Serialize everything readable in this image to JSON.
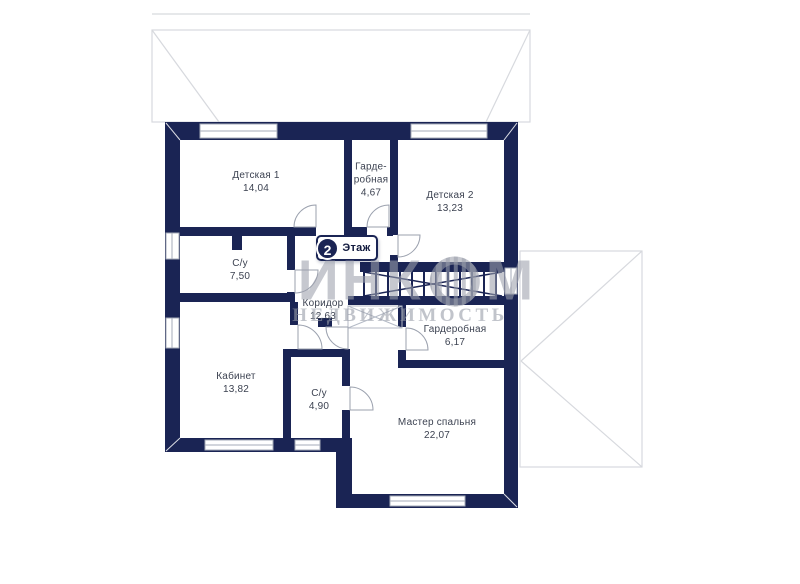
{
  "floor_badge": {
    "number": "2",
    "label": "Этаж"
  },
  "watermark": {
    "brand_pre": "ИНК",
    "brand_post": "М",
    "subtitle": "НЕДВИЖИМОСТЬ"
  },
  "rooms": [
    {
      "name": "Детская 1",
      "area": "14,04"
    },
    {
      "name": "Гарде-робная",
      "area": "4,67"
    },
    {
      "name": "Детская 2",
      "area": "13,23"
    },
    {
      "name": "С/у",
      "area": "7,50"
    },
    {
      "name": "Коридор",
      "area": "12,63"
    },
    {
      "name": "Гардеробная",
      "area": "6,17"
    },
    {
      "name": "Кабинет",
      "area": "13,82"
    },
    {
      "name": "С/у",
      "area": "4,90"
    },
    {
      "name": "Мастер спальня",
      "area": "22,07"
    }
  ],
  "colors": {
    "wall": "#1a2454",
    "label_text": "#3c4251",
    "roof_line": "#d7d9de",
    "watermark": "#9ca1ad",
    "door_line": "#9ba1ae"
  }
}
